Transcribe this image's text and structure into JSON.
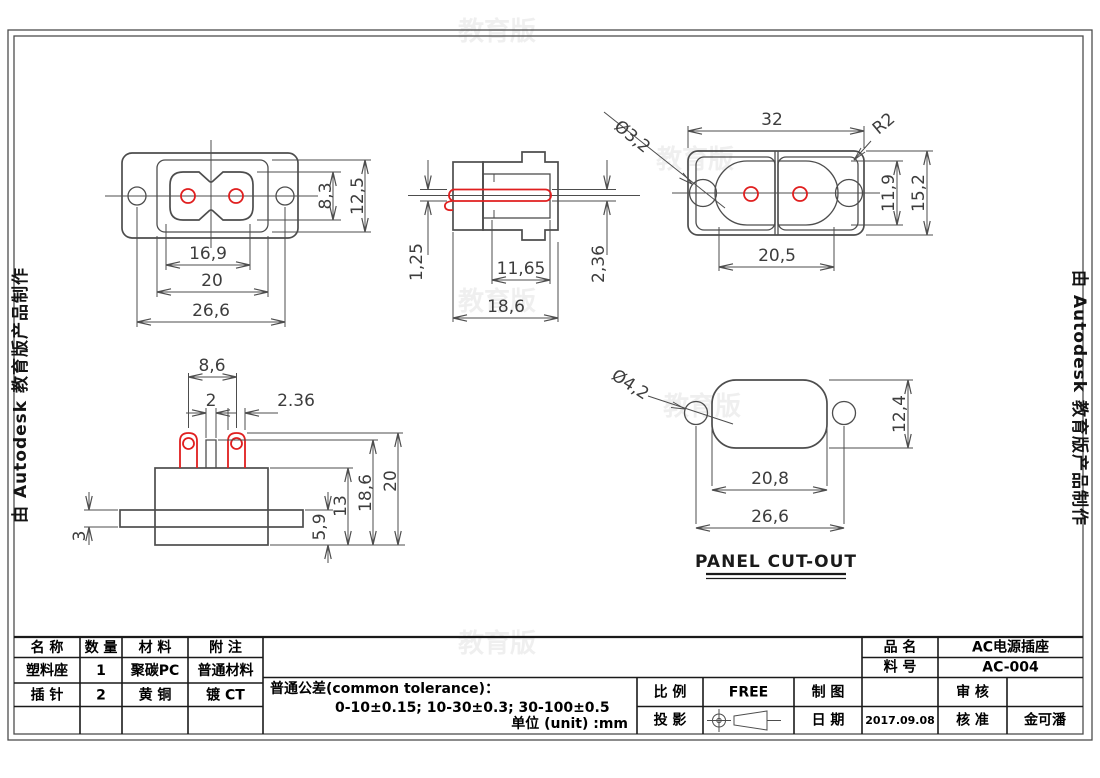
{
  "drawing": {
    "watermark_side": "由 Autodesk 教育版产品制作",
    "watermark_ghost": "教育版",
    "views": {
      "front": {
        "slot_w": "16,9",
        "body_w": "20",
        "span": "26,6",
        "slot_h": "8,3",
        "body_h": "12,5"
      },
      "section": {
        "tail": "1,25",
        "depth": "11,65",
        "total": "18,6",
        "pin": "2,36",
        "hole": "Ø3,2"
      },
      "rear": {
        "width": "32",
        "radius": "R2",
        "slot": "20,5",
        "inner_h": "11,9",
        "outer_h": "15,2"
      },
      "side": {
        "pin_span": "8,6",
        "rib": "2",
        "pin_w": "2.36",
        "flange": "3",
        "step": "5,9",
        "body": "13",
        "mid": "18,6",
        "total": "20"
      },
      "panel": {
        "hole": "Ø4,2",
        "slot": "20,8",
        "span": "26,6",
        "height": "12,4",
        "caption": "PANEL CUT-OUT"
      }
    }
  },
  "title_block": {
    "bom": {
      "headers": [
        "名 称",
        "数 量",
        "材 料",
        "附 注"
      ],
      "rows": [
        {
          "name": "塑料座",
          "qty": "1",
          "material": "聚碳PC",
          "note": "普通材料"
        },
        {
          "name": "插 针",
          "qty": "2",
          "material": "黄 铜",
          "note": "镀 CT"
        }
      ]
    },
    "tolerance": {
      "line1": "普通公差(common tolerance)：",
      "line2": "0-10±0.15;  10-30±0.3;  30-100±0.5",
      "line3": "单位 (unit) :mm"
    },
    "scale_label": "比 例",
    "scale_value": "FREE",
    "draft_label": "制 图",
    "draft_value": "",
    "projection_label": "投 影",
    "date_label": "日 期",
    "date_value": "2017.09.08",
    "product_label": "品 名",
    "product_value": "AC电源插座",
    "part_label": "料 号",
    "part_value": "AC-004",
    "review_label": "审 核",
    "review_value": "",
    "approve_label": "核 准",
    "approve_value": "金可潘"
  },
  "colors": {
    "line": "#4d4d4d",
    "accent_red": "#e01f1f",
    "text": "#000000"
  }
}
